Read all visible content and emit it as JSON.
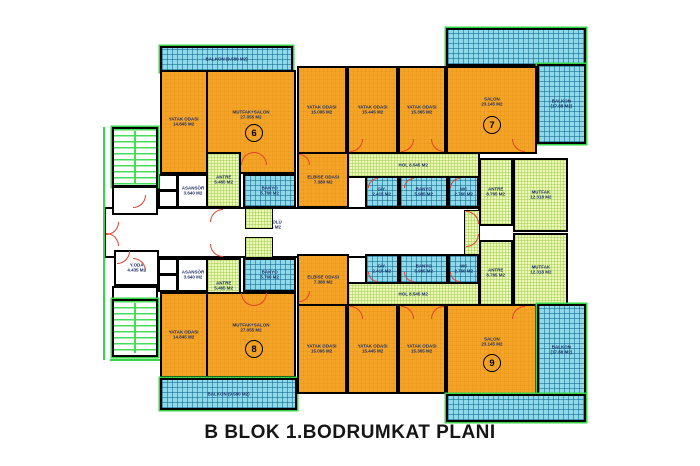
{
  "title": "B BLOK 1.BODRUMKAT PLANI",
  "units": [
    {
      "number": "6"
    },
    {
      "number": "7"
    },
    {
      "number": "8"
    },
    {
      "number": "9"
    }
  ],
  "rooms": [
    {
      "name": "YATAK ODASI",
      "area": "14.845 M2"
    },
    {
      "name": "MUTFAK+SALON",
      "area": "27.055 M2"
    },
    {
      "name": "ANTRE",
      "area": "5.465 M2"
    },
    {
      "name": "BANYO",
      "area": "5.760 M2"
    },
    {
      "name": "ASANSÖR",
      "area": "3.640 M2"
    },
    {
      "name": "BALKON",
      "area": "(9.580 M2)"
    },
    {
      "name": "YATAK ODASI",
      "area": "15.095 M2"
    },
    {
      "name": "YATAK ODASI",
      "area": "15.445 M2"
    },
    {
      "name": "YATAK ODASI",
      "area": "15.365 M2"
    },
    {
      "name": "SALON",
      "area": "23.145 M2"
    },
    {
      "name": "ELBİSE ODASI",
      "area": "7.380 M2"
    },
    {
      "name": "HOL",
      "area": "8.545 M2"
    },
    {
      "name": "GİY.",
      "area": "2.415 M2"
    },
    {
      "name": "BANYO",
      "area": "5.985 M2"
    },
    {
      "name": "WC",
      "area": "2.760 M2"
    },
    {
      "name": "ANTRE",
      "area": "8.765 M2"
    },
    {
      "name": "MUTFAK",
      "area": "12.318 M2"
    },
    {
      "name": "BALKON",
      "area": "(17.88 M2)"
    },
    {
      "name": "KAT HOLÜ",
      "area": "34.755 M2"
    },
    {
      "name": "Y.ODA",
      "area": "4.435 M2"
    },
    {
      "name": "ASANSÖR",
      "area": "3.640 M2"
    },
    {
      "name": "ANTRE",
      "area": "5.465 M2"
    },
    {
      "name": "BANYO",
      "area": "5.760 M2"
    },
    {
      "name": "YATAK ODASI",
      "area": "14.845 M2"
    },
    {
      "name": "MUTFAK+SALON",
      "area": "27.055 M2"
    },
    {
      "name": "BALKON",
      "area": "(9.580 M2)"
    },
    {
      "name": "YATAK ODASI",
      "area": "15.095 M2"
    },
    {
      "name": "YATAK ODASI",
      "area": "15.445 M2"
    },
    {
      "name": "YATAK ODASI",
      "area": "15.365 M2"
    },
    {
      "name": "SALON",
      "area": "23.145 M2"
    },
    {
      "name": "ELBİSE ODASI",
      "area": "7.380 M2"
    },
    {
      "name": "HOL",
      "area": "8.545 M2"
    },
    {
      "name": "GİY.",
      "area": "2.415 M2"
    },
    {
      "name": "BANYO",
      "area": "5.985 M2"
    },
    {
      "name": "WC",
      "area": "2.760 M2"
    },
    {
      "name": "ANTRE",
      "area": "8.765 M2"
    },
    {
      "name": "MUTFAK",
      "area": "12.318 M2"
    },
    {
      "name": "BALKON",
      "area": "(17.88 M2)"
    }
  ],
  "colors": {
    "room_orange": "#F5A427",
    "balcony_blue": "#8FD9EA",
    "service_green": "#EDF8B6",
    "wall_black": "#000000",
    "door_red": "#E2402A",
    "stair_green": "#35D54A",
    "label_navy": "#1C2F66"
  }
}
